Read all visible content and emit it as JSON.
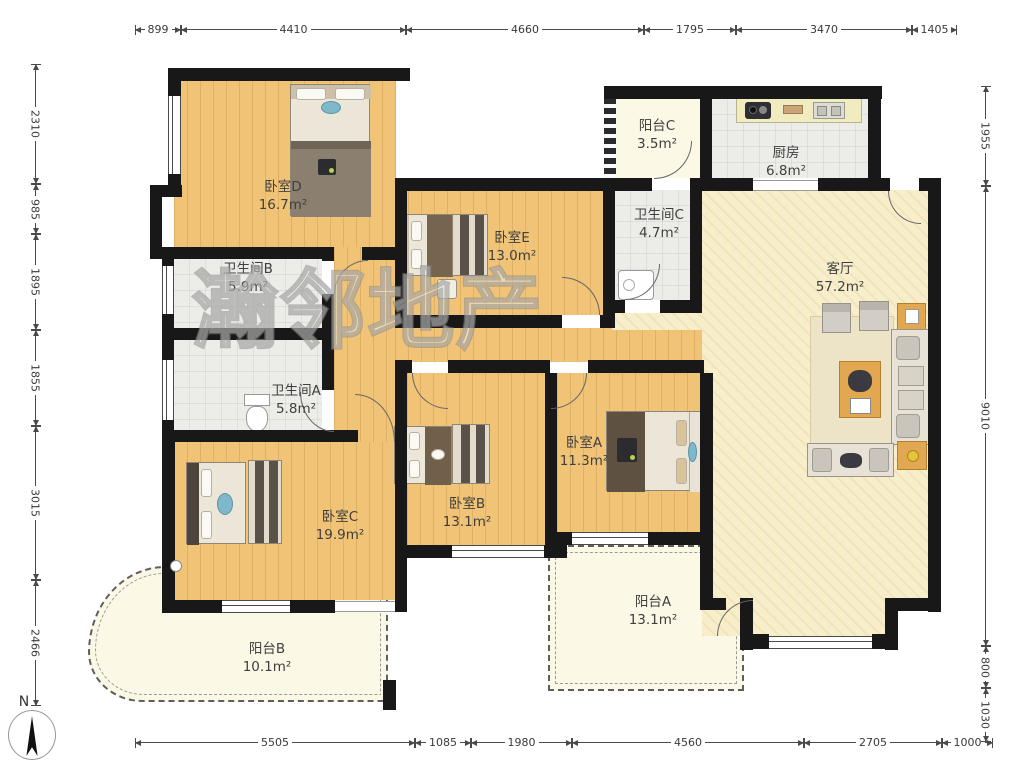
{
  "watermark": "瀚邻地产",
  "compass": {
    "n": "N"
  },
  "rooms": [
    {
      "id": "bedroom-d",
      "name": "卧室D",
      "area": "16.7m²"
    },
    {
      "id": "bedroom-e",
      "name": "卧室E",
      "area": "13.0m²"
    },
    {
      "id": "balcony-c",
      "name": "阳台C",
      "area": "3.5m²"
    },
    {
      "id": "kitchen",
      "name": "厨房",
      "area": "6.8m²"
    },
    {
      "id": "bathroom-c",
      "name": "卫生间C",
      "area": "4.7m²"
    },
    {
      "id": "bathroom-b",
      "name": "卫生间B",
      "area": "5.9m²"
    },
    {
      "id": "living-room",
      "name": "客厅",
      "area": "57.2m²"
    },
    {
      "id": "bathroom-a",
      "name": "卫生间A",
      "area": "5.8m²"
    },
    {
      "id": "bedroom-a",
      "name": "卧室A",
      "area": "11.3m²"
    },
    {
      "id": "bedroom-b",
      "name": "卧室B",
      "area": "13.1m²"
    },
    {
      "id": "bedroom-c",
      "name": "卧室C",
      "area": "19.9m²"
    },
    {
      "id": "balcony-a",
      "name": "阳台A",
      "area": "13.1m²"
    },
    {
      "id": "balcony-b",
      "name": "阳台B",
      "area": "10.1m²"
    }
  ],
  "dims": {
    "top": [
      "899",
      "4410",
      "4660",
      "1795",
      "3470",
      "1405"
    ],
    "bottom": [
      "5505",
      "1085",
      "1980",
      "4560",
      "2705",
      "1000"
    ],
    "left": [
      "2310",
      "985",
      "1895",
      "1855",
      "3015",
      "2466"
    ],
    "right": [
      "1955",
      "9010",
      "800",
      "1030"
    ]
  },
  "colors": {
    "wood_floor": "#f0c376",
    "living_floor": "#f7eecb",
    "tile_floor": "#ececE8",
    "balcony_floor": "#fbf8e6",
    "wall": "#181818",
    "accent_table": "#e2a851"
  }
}
